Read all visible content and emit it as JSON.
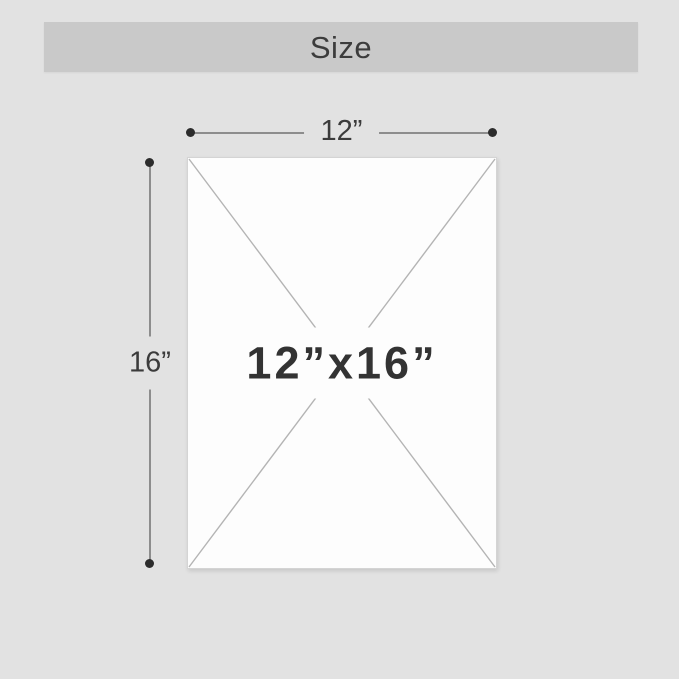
{
  "header": {
    "title": "Size",
    "background_color": "#c9c9c9",
    "text_color": "#3c3c3c"
  },
  "diagram": {
    "placeholder_label": "12”x16”",
    "width_label": "12”",
    "height_label": "16”",
    "panel_fill": "#fdfdfd",
    "panel_border_color": "#d4d4d4",
    "diagonal_color": "#b4b4b4",
    "dimension_line_color": "#8d8d8d",
    "dimension_dot_color": "#2c2c2c",
    "dimension_label_color": "#3b3b3b",
    "placeholder_text_color": "#333333",
    "page_background_color": "#e2e2e2"
  }
}
